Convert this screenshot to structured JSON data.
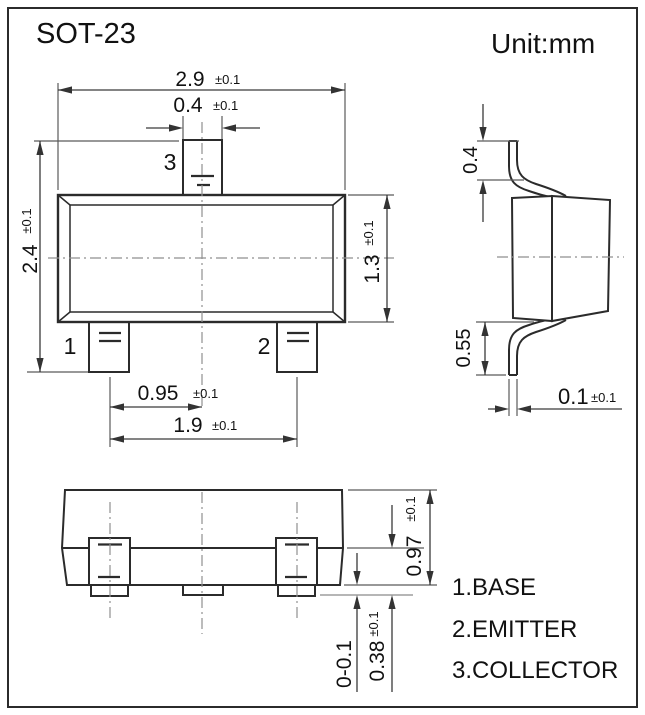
{
  "page": {
    "title": "SOT-23",
    "unit": "Unit:mm"
  },
  "package": "SOT-23",
  "front": {
    "pin1": "1",
    "pin2": "2",
    "pin3": "3"
  },
  "dims": {
    "body_width": {
      "v": "2.9",
      "t": "±0.1"
    },
    "tab_width": {
      "v": "0.4",
      "t": "±0.1"
    },
    "overall_height": {
      "v": "2.4",
      "t": "±0.1"
    },
    "body_height": {
      "v": "1.3",
      "t": "±0.1"
    },
    "lead_pitch": {
      "v": "0.95",
      "t": "±0.1"
    },
    "lead_span": {
      "v": "1.9",
      "t": "±0.1"
    },
    "top_lead_height": {
      "v": "0.4"
    },
    "bottom_lead_height": {
      "v": "0.55"
    },
    "lead_thickness": {
      "v": "0.1",
      "t": "±0.1"
    },
    "profile_height": {
      "v": "0.97",
      "t": "±0.1"
    },
    "standoff": {
      "v": "0-0.1"
    },
    "foot_height": {
      "v": "0.38",
      "t": "±0.1"
    }
  },
  "legend": {
    "items": [
      {
        "label": "1.BASE"
      },
      {
        "label": "2.EMITTER"
      },
      {
        "label": "3.COLLECTOR"
      }
    ]
  },
  "colors": {
    "ink": "#2b2b2b",
    "dimension": "#3a3a3a",
    "centerline": "#8f8f8f",
    "background": "#ffffff"
  }
}
